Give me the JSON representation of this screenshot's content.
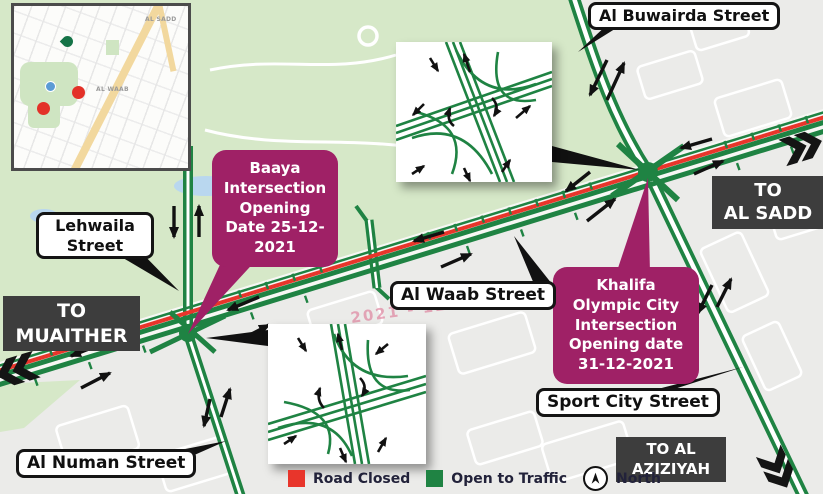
{
  "street_labels": {
    "al_buwairda": "Al Buwairda Street",
    "lehwaila": "Lehwaila\nStreet",
    "al_waab": "Al Waab Street",
    "sport_city": "Sport City Street",
    "al_numan": "Al Numan Street"
  },
  "destinations": {
    "muaither": "TO\nMUAITHER",
    "al_sadd": "TO\nAL SADD",
    "al_aziziyah": "TO AL\nAZIZIYAH"
  },
  "callouts": {
    "baaya": "Baaya\nIntersection\nOpening\nDate 25-12-\n2021",
    "khalifa": "Khalifa\nOlympic City\nIntersection\nOpening date\n31-12-2021"
  },
  "watermark": "2021 - 12 - 25",
  "legend": {
    "road_closed": "Road Closed",
    "open_to_traffic": "Open to Traffic",
    "north": "North"
  },
  "inset_map": {
    "labels": [
      "AL SADD",
      "AL WAAB"
    ]
  },
  "colors": {
    "road_open": "#1f8343",
    "road_closed": "#e8352b",
    "callout": "#9f2166",
    "park": "#d6e8c8",
    "urban": "#ebebe9",
    "dest_box": "#3d3d3d"
  },
  "map_symbols": {
    "arrows": [
      [
        607,
        60,
        590,
        95
      ],
      [
        607,
        100,
        624,
        63
      ],
      [
        590,
        172,
        566,
        191
      ],
      [
        587,
        221,
        615,
        199
      ],
      [
        712,
        139,
        681,
        148
      ],
      [
        694,
        174,
        723,
        161
      ],
      [
        444,
        232,
        414,
        241
      ],
      [
        441,
        267,
        471,
        254
      ],
      [
        101,
        344,
        71,
        356
      ],
      [
        81,
        388,
        110,
        373
      ],
      [
        259,
        297,
        228,
        310
      ],
      [
        240,
        340,
        269,
        325
      ],
      [
        210,
        399,
        204,
        426
      ],
      [
        221,
        417,
        230,
        389
      ],
      [
        174,
        206,
        174,
        237
      ],
      [
        199,
        237,
        199,
        206
      ],
      [
        712,
        285,
        698,
        313
      ],
      [
        717,
        307,
        731,
        279
      ]
    ],
    "chevrons": [
      [
        20,
        371,
        163
      ],
      [
        799,
        146,
        -17
      ],
      [
        778,
        466,
        63
      ]
    ]
  }
}
